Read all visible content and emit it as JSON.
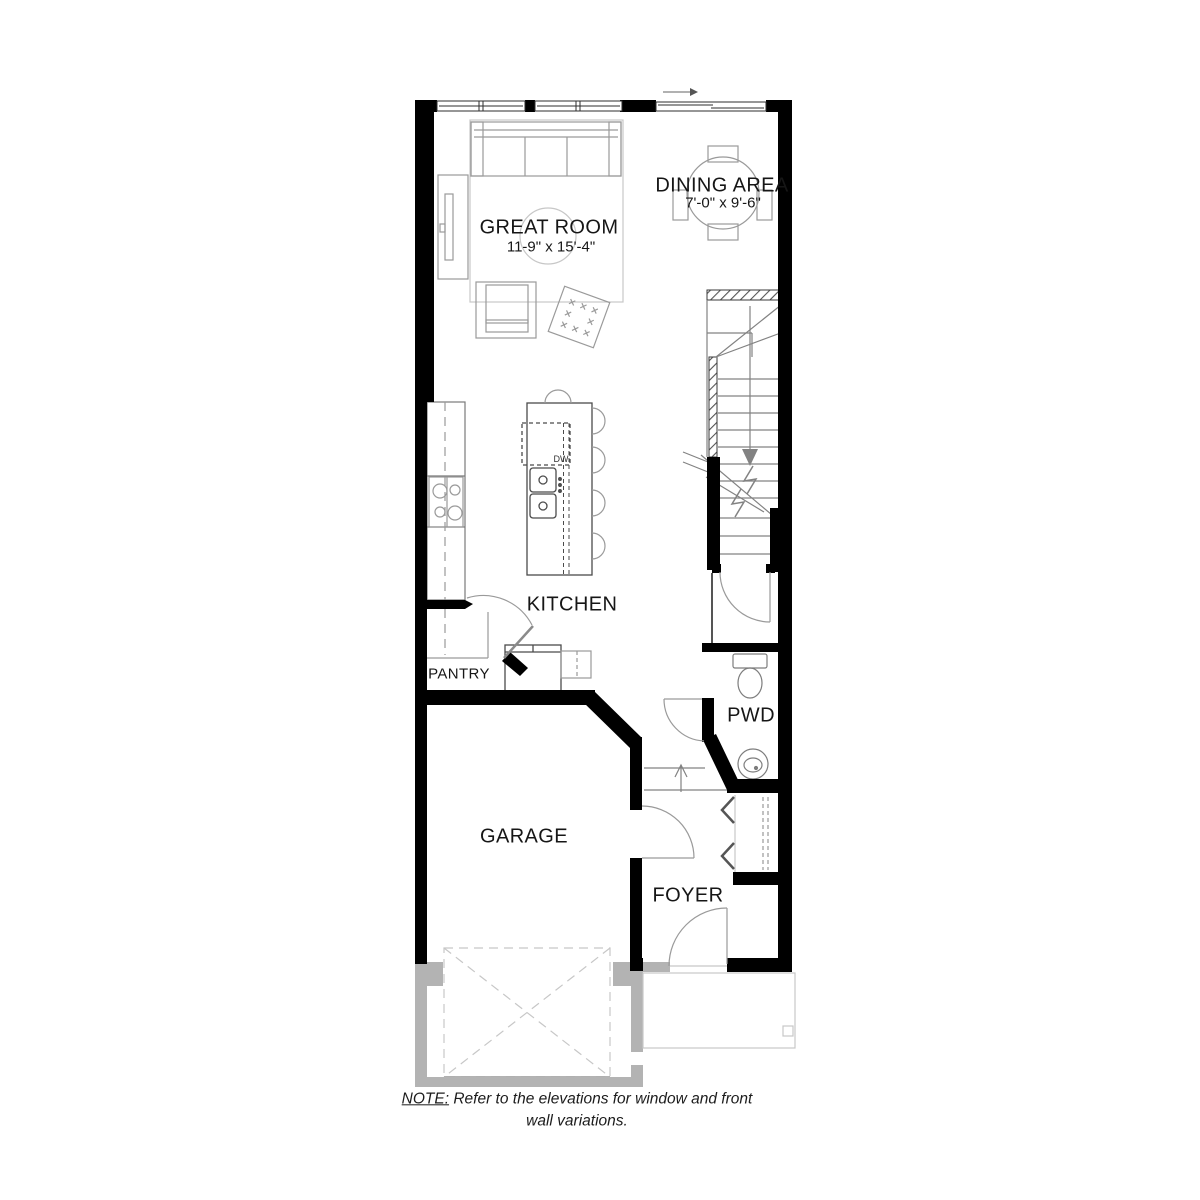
{
  "title": "Main floor plan",
  "rooms": {
    "great_room": {
      "name": "GREAT ROOM",
      "dims": "11-9\" x 15'-4\""
    },
    "dining_area": {
      "name": "DINING AREA",
      "dims": "7'-0\" x 9'-6\""
    },
    "kitchen": {
      "name": "KITCHEN"
    },
    "pantry": {
      "name": "PANTRY"
    },
    "pwd": {
      "name": "PWD"
    },
    "garage": {
      "name": "GARAGE"
    },
    "foyer": {
      "name": "FOYER"
    }
  },
  "appliances": {
    "dishwasher_label": "DW"
  },
  "note": {
    "prefix": "NOTE:",
    "rest_line1": " Refer to the elevations for window and front",
    "line2": "wall variations."
  },
  "colors": {
    "wall": "#000000",
    "gray_wall": "#b3b3b3",
    "furniture_line": "#9a9a9a",
    "light_line": "#c7c7c7",
    "stair_line": "#828282",
    "text": "#161616",
    "background": "#ffffff"
  }
}
